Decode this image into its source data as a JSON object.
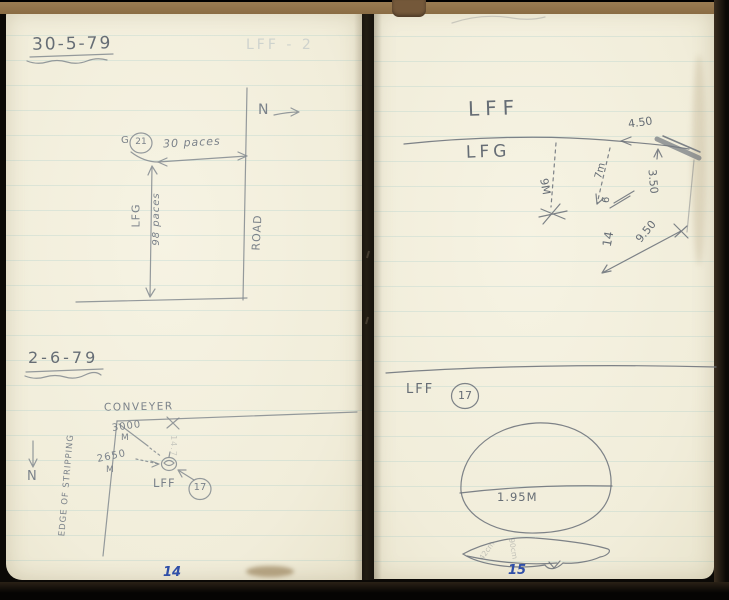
{
  "scan": {
    "left_page_number": "14",
    "right_page_number": "15"
  },
  "left_page": {
    "entry_1": {
      "date": "30-5-79",
      "ghost_note": "LFF - 2",
      "north_label": "N",
      "station_prefix": "G",
      "station_number": "21",
      "top_measure": "30 paces",
      "side_label": "LFG",
      "side_measure": "98 paces",
      "road_label": "ROAD"
    },
    "entry_2": {
      "date": "2-6-79",
      "conveyor_label": "CONVEYER",
      "distance_1": "3000",
      "distance_1_unit": "M",
      "distance_2": "2650",
      "distance_2_unit": "M",
      "faint_measure": "14.7",
      "target_label": "LFF",
      "target_number": "17",
      "edge_label": "EDGE OF STRIPPING",
      "north_label": "N"
    }
  },
  "right_page": {
    "survey": {
      "area_label": "LFF",
      "sub_area_label": "LFG",
      "depth_measure": "9M",
      "measure_7m": "7m",
      "measure_6": "6",
      "measure_14": "14",
      "measure_450": "4.50",
      "measure_350": "3.50",
      "measure_950": "9.50"
    },
    "section": {
      "label": "LFF",
      "number": "17"
    },
    "tunnel_sketch": {
      "width": "1.95M"
    },
    "seam_sketch": {
      "measure_a": "42cm",
      "measure_b": "90cm"
    }
  }
}
